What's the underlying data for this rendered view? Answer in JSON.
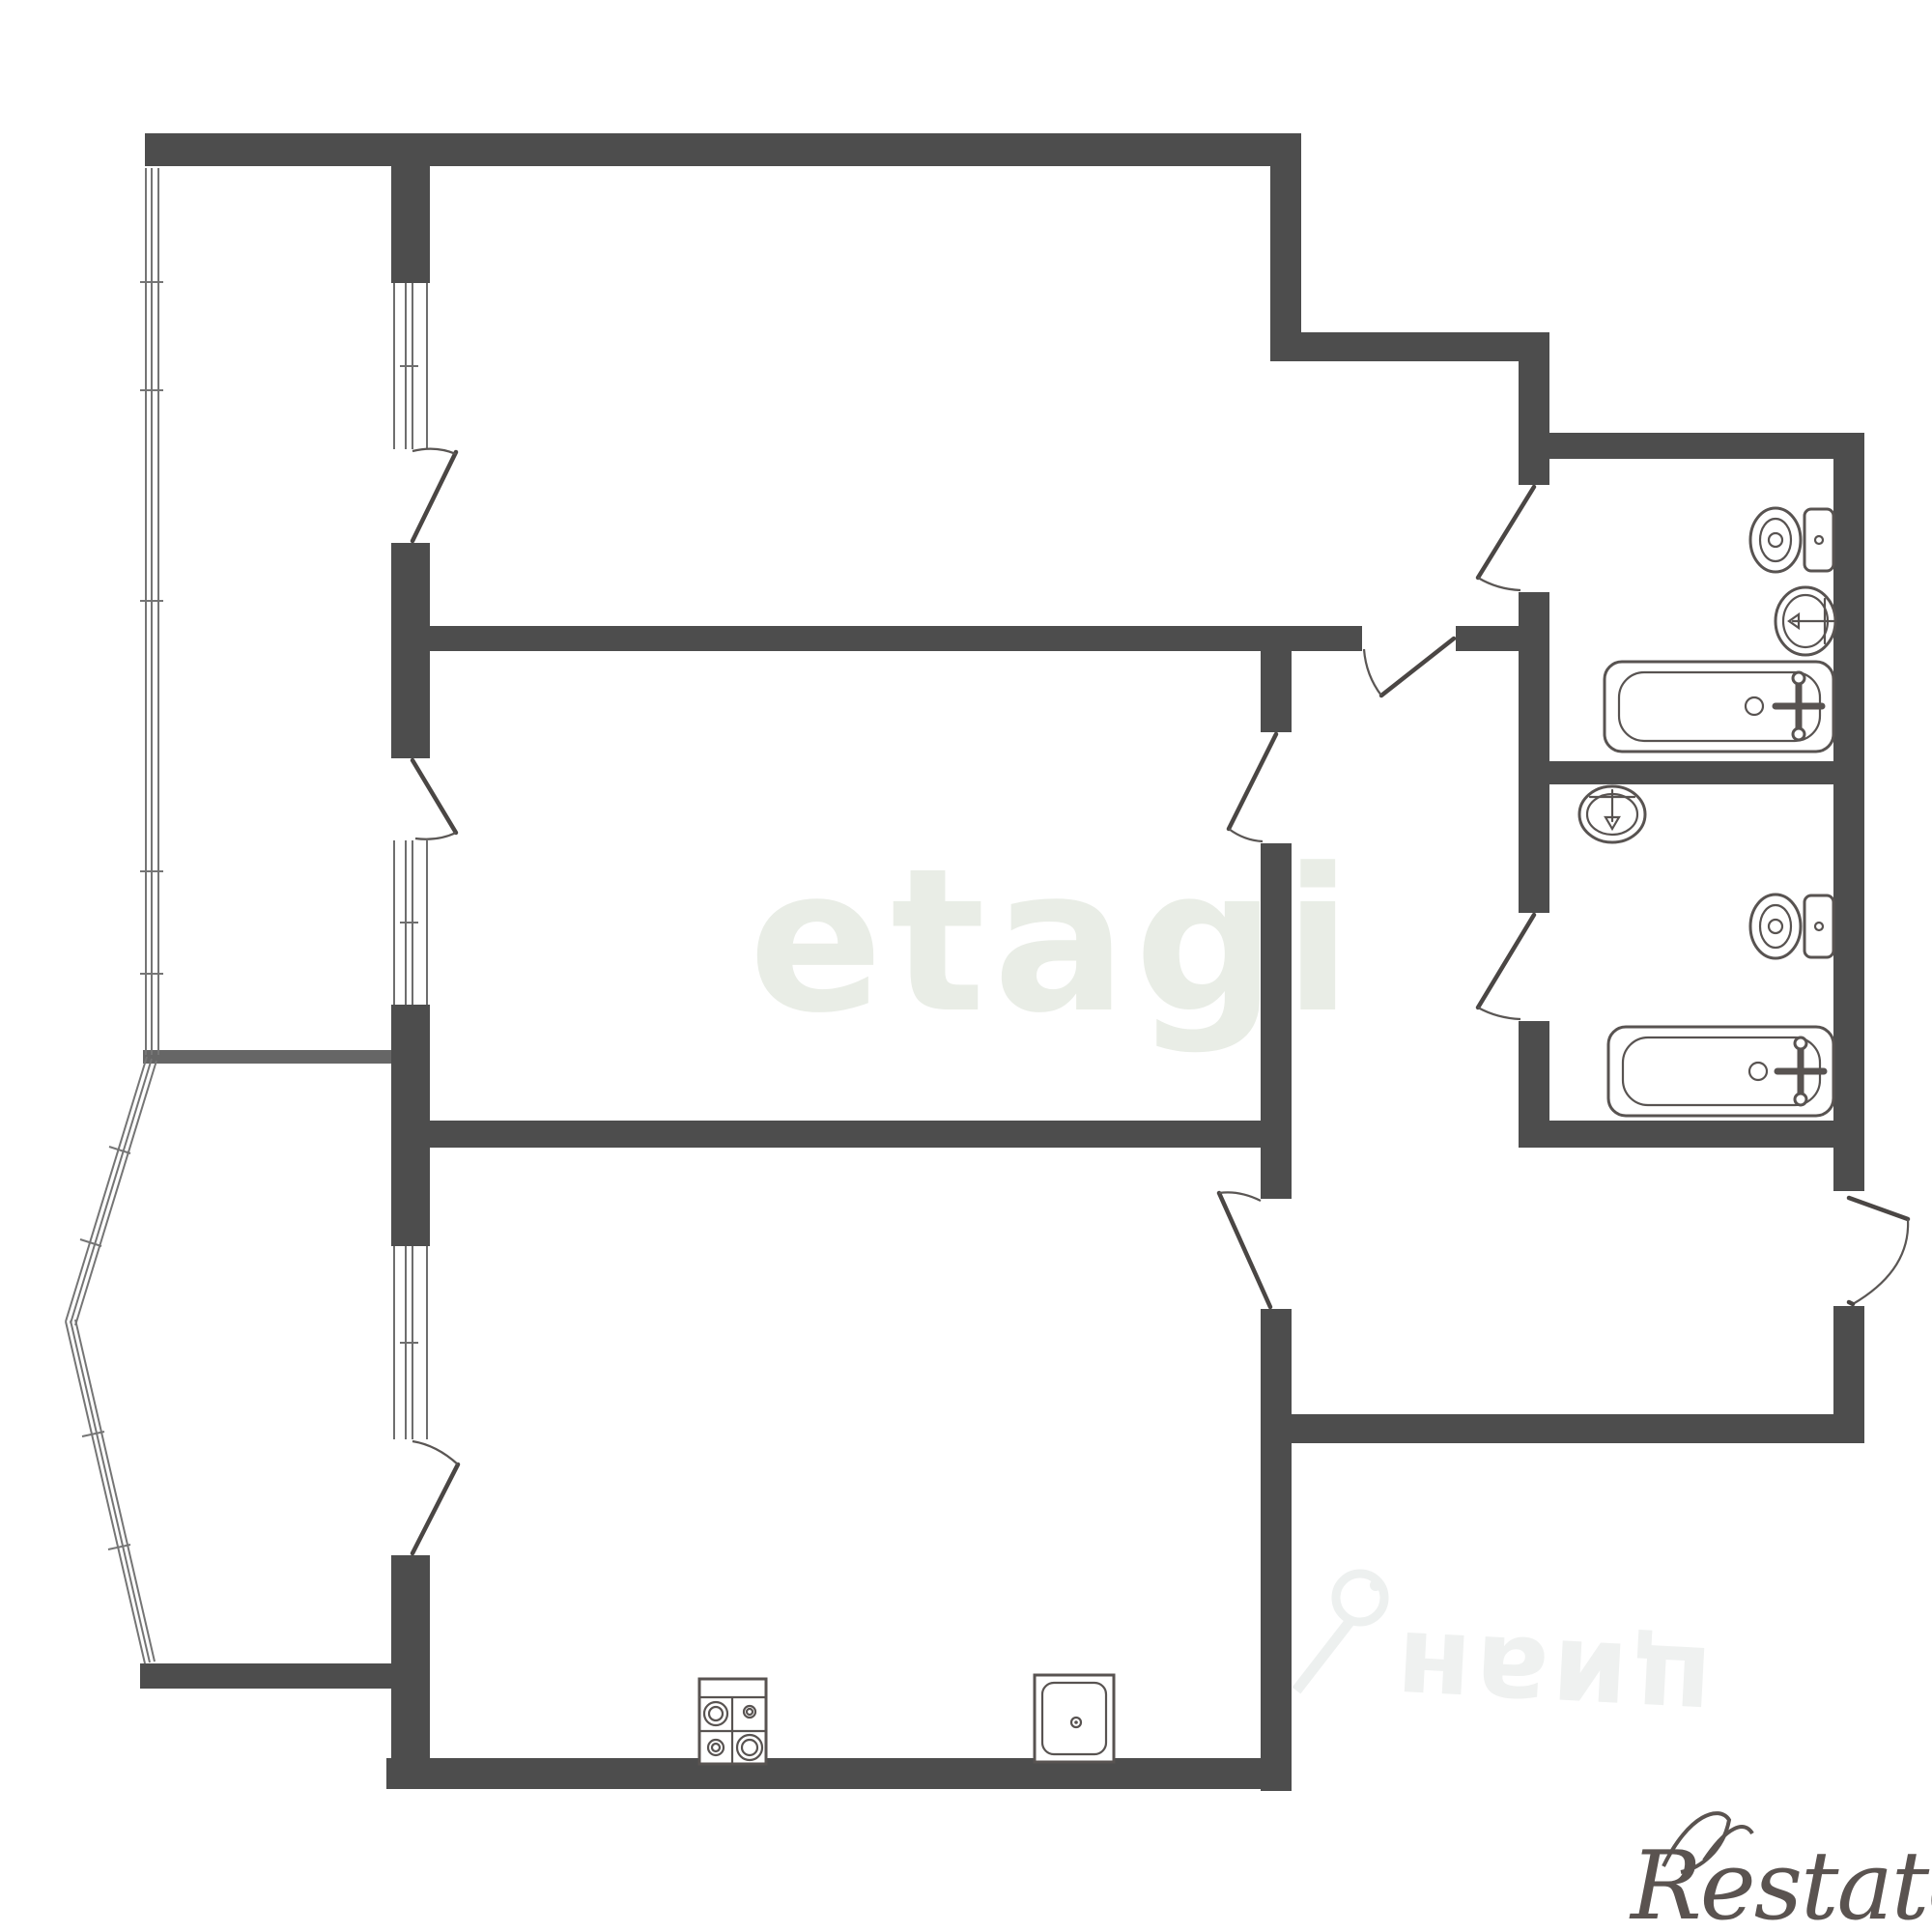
{
  "document": {
    "type": "apartment-floor-plan",
    "style": "black-and-white architectural drawing"
  },
  "watermarks": {
    "center_brand": "etagi",
    "listing_site": "циан",
    "corner_brand": "Restate"
  },
  "colors": {
    "background": "#ffffff",
    "wall": "#4d4d4d",
    "fixture_line": "#585351",
    "glazing_line": "#757575",
    "watermark_center": "#e9ede6",
    "watermark_cian": "#eff1f0",
    "watermark_restate": "#5a5350"
  },
  "plan": {
    "rooms": [
      {
        "name": "bedroom-top-left",
        "features": [
          "balcony-window",
          "balcony-door",
          "ensuite-nook"
        ]
      },
      {
        "name": "living-room-center",
        "features": [
          "balcony-window",
          "balcony-door",
          "corridor-door"
        ]
      },
      {
        "name": "kitchen-bottom",
        "features": [
          "bay-window",
          "bay-door",
          "corridor-door",
          "stove",
          "sink"
        ]
      },
      {
        "name": "bathroom-top-right",
        "fixtures": [
          "toilet",
          "wash-basin",
          "bathtub"
        ]
      },
      {
        "name": "bathroom-mid-right",
        "fixtures": [
          "wash-basin",
          "toilet",
          "bathtub"
        ]
      },
      {
        "name": "corridor-center",
        "features": [
          "connects-all-rooms"
        ]
      },
      {
        "name": "entry-hall-bottom-right",
        "features": [
          "entrance-door-right-wall"
        ]
      },
      {
        "name": "balcony-left-strip-with-bay",
        "features": [
          "triple-line-glazing"
        ]
      }
    ],
    "doors_count": 9,
    "windows_count": 3
  }
}
